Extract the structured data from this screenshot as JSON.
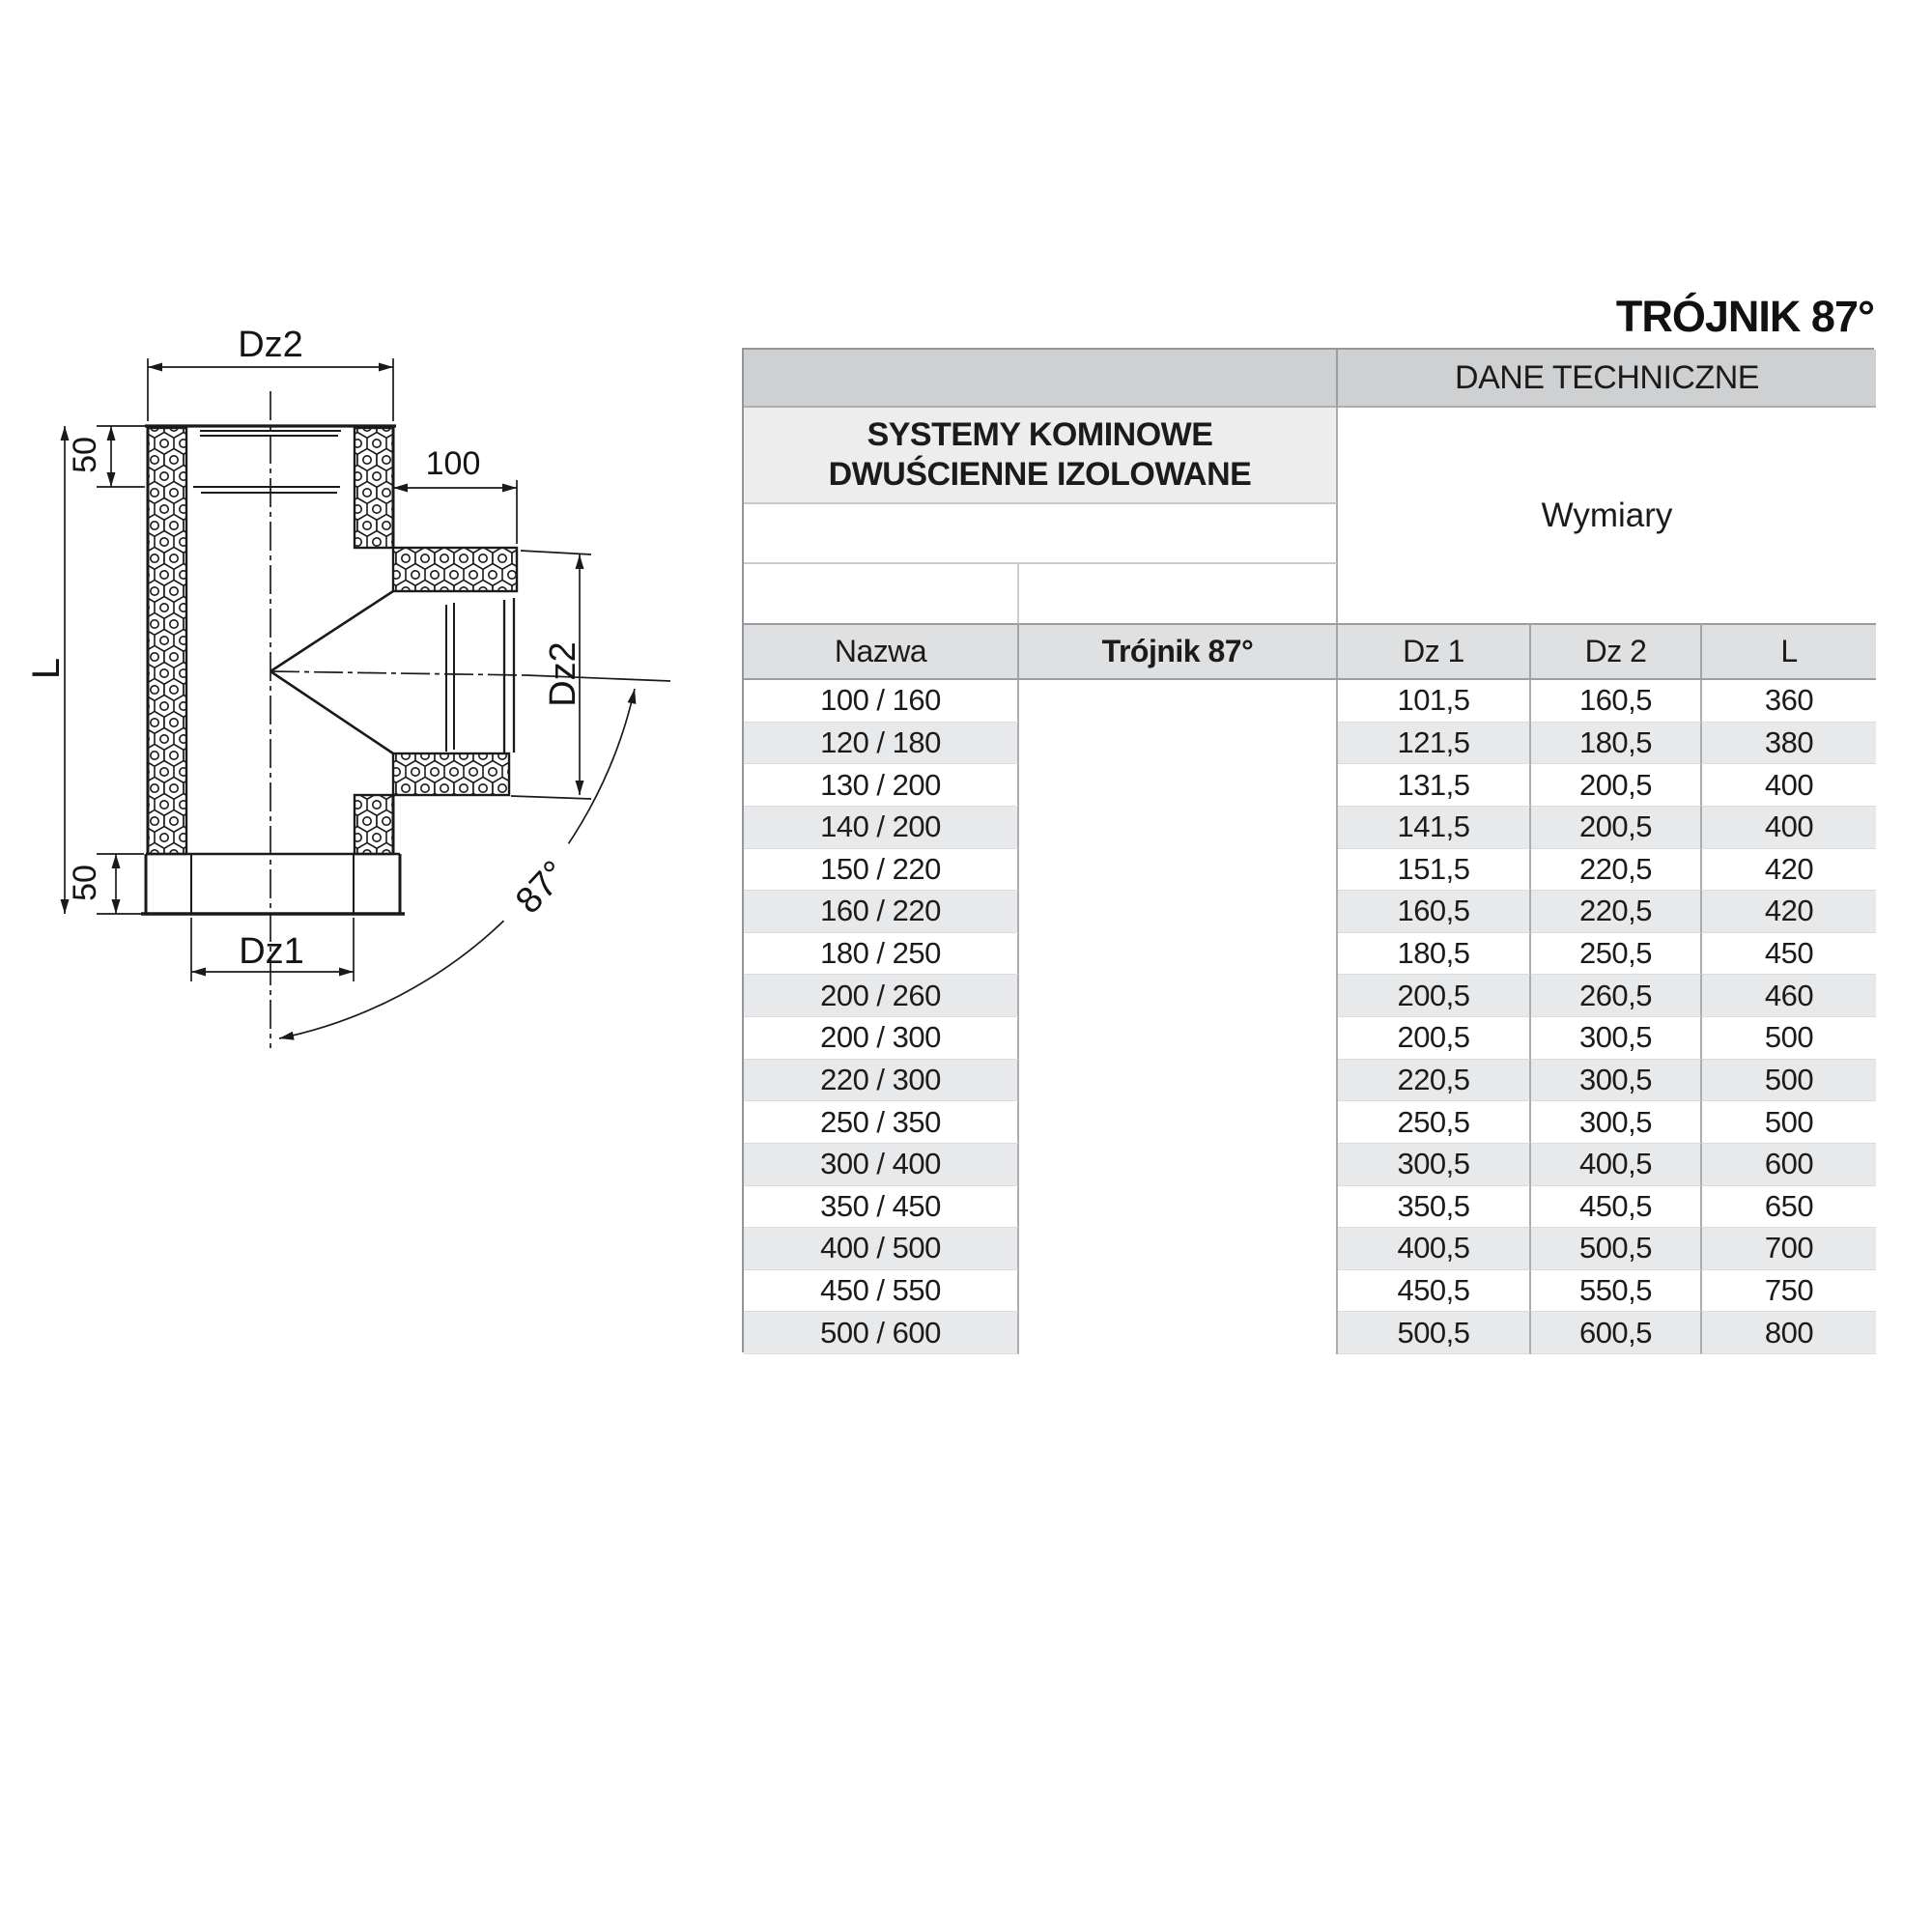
{
  "page_title": "TRÓJNIK 87°",
  "diagram": {
    "dim_top_diameter": "Dz2",
    "dim_top_collar": "50",
    "dim_branch_length": "100",
    "dim_total_length": "L",
    "dim_branch_diameter": "Dz2",
    "dim_bottom_collar": "50",
    "dim_bottom_diameter": "Dz1",
    "dim_branch_angle": "87°"
  },
  "table": {
    "section_header": "DANE TECHNICZNE",
    "product_line1": "SYSTEMY KOMINOWE",
    "product_line2": "DWUŚCIENNE IZOLOWANE",
    "dimensions_header": "Wymiary",
    "columns": {
      "name": "Nazwa",
      "product": "Trójnik 87°",
      "dz1": "Dz 1",
      "dz2": "Dz 2",
      "l": "L"
    },
    "rows": [
      {
        "name": "100 / 160",
        "dz1": "101,5",
        "dz2": "160,5",
        "l": "360"
      },
      {
        "name": "120 / 180",
        "dz1": "121,5",
        "dz2": "180,5",
        "l": "380"
      },
      {
        "name": "130 / 200",
        "dz1": "131,5",
        "dz2": "200,5",
        "l": "400"
      },
      {
        "name": "140 / 200",
        "dz1": "141,5",
        "dz2": "200,5",
        "l": "400"
      },
      {
        "name": "150 / 220",
        "dz1": "151,5",
        "dz2": "220,5",
        "l": "420"
      },
      {
        "name": "160 / 220",
        "dz1": "160,5",
        "dz2": "220,5",
        "l": "420"
      },
      {
        "name": "180 / 250",
        "dz1": "180,5",
        "dz2": "250,5",
        "l": "450"
      },
      {
        "name": "200 / 260",
        "dz1": "200,5",
        "dz2": "260,5",
        "l": "460"
      },
      {
        "name": "200 / 300",
        "dz1": "200,5",
        "dz2": "300,5",
        "l": "500"
      },
      {
        "name": "220 / 300",
        "dz1": "220,5",
        "dz2": "300,5",
        "l": "500"
      },
      {
        "name": "250 / 350",
        "dz1": "250,5",
        "dz2": "300,5",
        "l": "500"
      },
      {
        "name": "300 / 400",
        "dz1": "300,5",
        "dz2": "400,5",
        "l": "600"
      },
      {
        "name": "350 / 450",
        "dz1": "350,5",
        "dz2": "450,5",
        "l": "650"
      },
      {
        "name": "400 / 500",
        "dz1": "400,5",
        "dz2": "500,5",
        "l": "700"
      },
      {
        "name": "450 / 550",
        "dz1": "450,5",
        "dz2": "550,5",
        "l": "750"
      },
      {
        "name": "500 / 600",
        "dz1": "500,5",
        "dz2": "600,5",
        "l": "800"
      }
    ]
  },
  "colors": {
    "header_gray": "#ced0d2",
    "subheader_gray": "#ededee",
    "column_header_gray": "#dfe0e1",
    "stripe_gray": "#e8e9ea",
    "line_black": "#1a1a1a"
  }
}
